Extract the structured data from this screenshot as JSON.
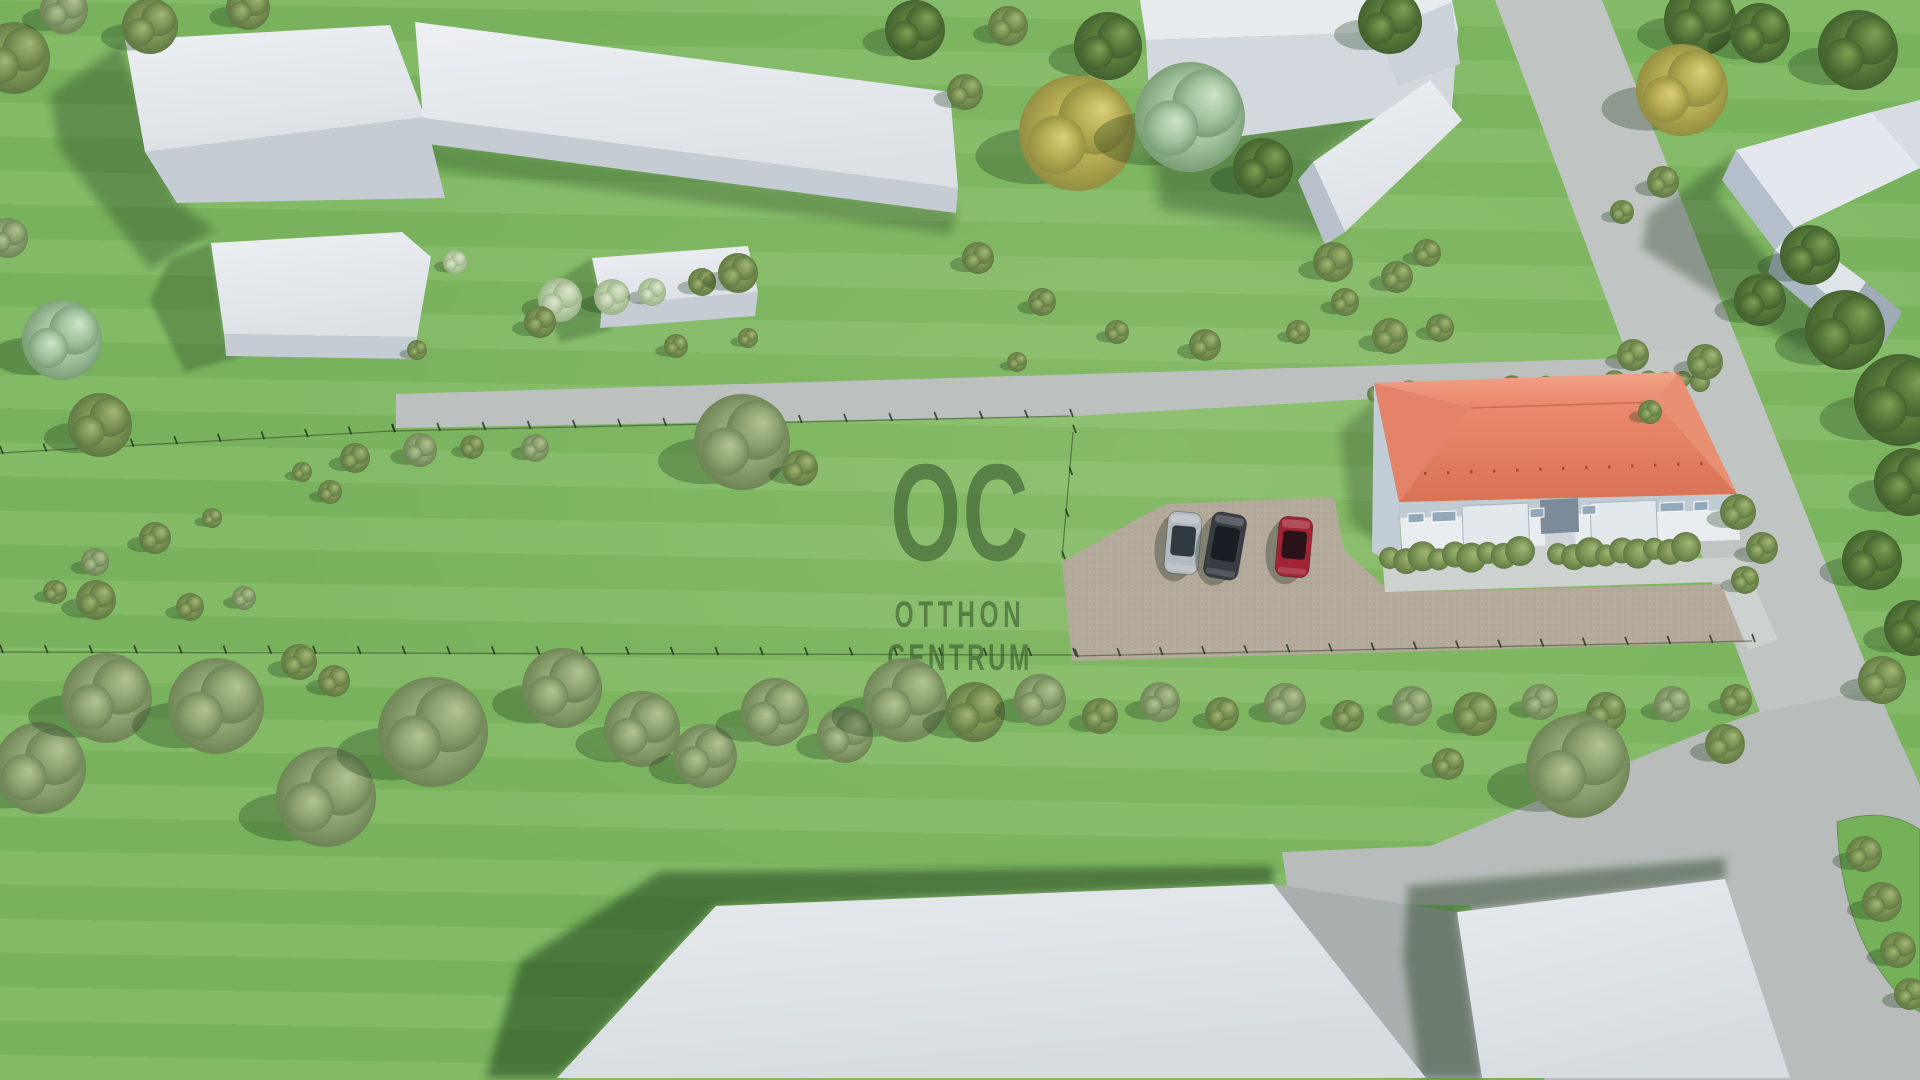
{
  "watermark": {
    "monogram": "OC",
    "line1": "OTTHON",
    "line2": "CENTRUM",
    "color": "#34542c"
  },
  "palette": {
    "grass": "#7bb65e",
    "road": "#bcc0be",
    "walkway": "#cdd1cf",
    "gravel": "#b4aa9b",
    "roof_red": "#e08a6b",
    "building_white": "#e2e6ea",
    "building_side": "#c2c9d2",
    "shadow_green": "#1c381a",
    "watermark_green": "#34542c",
    "car_silver": "#b4bbc0",
    "car_black": "#383d44",
    "car_red": "#a02433"
  },
  "scene": {
    "roads": [
      {
        "name": "main-street-horizontal",
        "pts": "396,394 1705,356 1705,380 1073,416 396,428",
        "fill": "#bcc0be"
      },
      {
        "name": "side-street-vertical",
        "pts": "1495,0 1602,0 1876,690 1760,712",
        "fill": "#c0c4c2"
      },
      {
        "name": "road-curve-apron",
        "path": "M1282,852 L1430,846 C1520,810 1654,748 1758,712 L1878,690 C1898,738 1912,766 1920,786 L1920,1080 L1545,1080 L1470,905 L1290,905 Z",
        "fill": "#b8bcba"
      },
      {
        "name": "road-wedge-between-buildings",
        "pts": "1273,884 1457,912 1482,1078 1426,1078",
        "fill": "#a9afae"
      },
      {
        "name": "grass-island",
        "path": "M1837,822 C1870,810 1900,815 1920,830 L1920,1012 C1900,1000 1880,975 1862,940 C1848,908 1838,865 1837,822 Z",
        "fill": "#74b158",
        "stroke": "rgba(60,90,50,0.45)"
      }
    ],
    "plot": [
      {
        "name": "gravel-parking",
        "pts": "1062,562 1142,516 1166,504 1334,497 1344,550 1390,592 1735,584 1748,642 1072,661",
        "fill": "#b4aa9b",
        "pattern": "grv"
      },
      {
        "name": "north-path",
        "pts": "1640,352 1706,347 1714,371 1648,377",
        "fill": "#c3c7c5"
      },
      {
        "name": "front-walkway",
        "pts": "1383,567 1748,557 1752,581 1385,592",
        "fill": "#cdd1cf"
      },
      {
        "name": "cross-walkway",
        "pts": "1527,545 1556,543 1558,570 1529,572",
        "fill": "#cdd1cf"
      },
      {
        "name": "link-walkway-to-road",
        "pts": "1712,562 1742,558 1778,640 1748,650",
        "fill": "#cdd1cf"
      }
    ],
    "fences": [
      {
        "name": "north-fence-west",
        "x1": 0,
        "y1": 453,
        "x2": 392,
        "y2": 431,
        "posts": 9
      },
      {
        "name": "north-fence-east",
        "x1": 392,
        "y1": 431,
        "x2": 1070,
        "y2": 416,
        "posts": 15
      },
      {
        "name": "west-fence",
        "x1": 1073,
        "y1": 432,
        "x2": 1062,
        "y2": 558,
        "posts": 3
      },
      {
        "name": "south-fence-west",
        "x1": 0,
        "y1": 652,
        "x2": 1073,
        "y2": 655,
        "posts": 24
      },
      {
        "name": "south-fence-east",
        "x1": 1075,
        "y1": 656,
        "x2": 1752,
        "y2": 641,
        "posts": 16
      }
    ],
    "shadows": [
      {
        "name": "shadow-building-topleft-1",
        "pts": "50,95 120,45 175,200 215,230 150,268 60,150",
        "op": 0.32,
        "blur": "f4"
      },
      {
        "name": "shadow-building-topleft-2",
        "pts": "405,140 958,210 950,234 400,164",
        "op": 0.28,
        "blur": "f4"
      },
      {
        "name": "shadow-block-3",
        "pts": "170,260 211,243 224,334 242,356 185,372 150,300",
        "op": 0.3,
        "blur": "f2"
      },
      {
        "name": "shadow-block-4",
        "pts": "558,280 592,258 602,305 612,330 560,342 544,300",
        "op": 0.28,
        "blur": "f2"
      },
      {
        "name": "shadow-courtyard",
        "pts": "1150,135 1452,108 1430,80 1313,162 1340,235 1160,208",
        "op": 0.36,
        "blur": "f6"
      },
      {
        "name": "shadow-corner-house",
        "pts": "1648,215 1736,152 1716,196 1770,262 1836,315 1806,352 1700,285 1642,248",
        "op": 0.33,
        "blur": "f4"
      },
      {
        "name": "shadow-red-house",
        "pts": "1340,430 1380,395 1396,500 1402,565 1350,522",
        "op": 0.26,
        "blur": "f4"
      },
      {
        "name": "shadow-bottom-building-1",
        "pts": "660,872 1273,866 1273,884 716,906 557,1078 486,1078 520,962",
        "op": 0.5,
        "blur": "f4"
      },
      {
        "name": "shadow-bottom-building-2",
        "pts": "1408,886 1725,858 1725,879 1457,912 1482,1078 1420,1078 1404,960",
        "op": 0.42,
        "blur": "f4"
      }
    ],
    "buildings": [
      {
        "name": "building-topleft-1-roof",
        "pts": "125,40 390,25 425,117 145,152",
        "fill": "url(#gTop)"
      },
      {
        "name": "building-topleft-1-side",
        "pts": "145,152 425,117 445,198 177,203",
        "fill": "#c6ccd4"
      },
      {
        "name": "building-topleft-2-roof",
        "pts": "415,22 950,92 958,188 423,118",
        "fill": "url(#gTop)"
      },
      {
        "name": "building-topleft-2-side",
        "pts": "423,118 958,188 956,213 421,143",
        "fill": "#c6ccd4"
      },
      {
        "name": "block-3-roof",
        "pts": "211,243 402,232 431,257 417,337 224,334",
        "fill": "url(#gTop)"
      },
      {
        "name": "block-3-side",
        "pts": "224,334 417,337 415,359 226,356",
        "fill": "#c6ccd4"
      },
      {
        "name": "block-4-roof",
        "pts": "592,258 748,246 758,292 602,305",
        "fill": "url(#gTop)"
      },
      {
        "name": "block-4-side",
        "pts": "602,305 758,292 755,316 600,328",
        "fill": "#c6ccd4"
      },
      {
        "name": "wall-top-cap",
        "pts": "1140,0 1452,0 1458,30 1146,40",
        "fill": "#e8ebee"
      },
      {
        "name": "wall-top-face",
        "pts": "1146,40 1458,30 1452,108 1152,148",
        "fill": "#d3d8de"
      },
      {
        "name": "wall-corner",
        "pts": "1378,34 1452,2 1460,64 1398,86",
        "fill": "#ccd2d9"
      },
      {
        "name": "diagonal-building-roof",
        "pts": "1313,162 1430,80 1462,120 1345,232",
        "fill": "url(#gTop)"
      },
      {
        "name": "diagonal-building-end",
        "pts": "1313,162 1345,232 1325,245 1298,180",
        "fill": "#b8c1cb"
      },
      {
        "name": "corner-house-main-roof",
        "pts": "1736,150 1872,112 1920,168 1794,228",
        "fill": "#e4e8ee"
      },
      {
        "name": "corner-house-roof-right",
        "pts": "1872,112 1920,100 1920,168",
        "fill": "#d8dde4"
      },
      {
        "name": "corner-house-left-wall",
        "pts": "1736,150 1794,228 1775,250 1722,180",
        "fill": "#b4bfcb"
      },
      {
        "name": "corner-house-wing-roof",
        "pts": "1775,250 1794,228 1866,282 1846,312",
        "fill": "#dfe4ea"
      },
      {
        "name": "corner-house-wing-wall",
        "pts": "1775,250 1846,312 1836,330 1768,272",
        "fill": "#aab6c3"
      },
      {
        "name": "corner-house-gable",
        "pts": "1846,312 1866,282 1902,312 1884,344",
        "fill": "#9fabb9"
      },
      {
        "name": "bottom-building-1",
        "pts": "716,906 1273,884 1426,1078 557,1078",
        "fill": "url(#gBot)"
      },
      {
        "name": "bottom-building-2",
        "pts": "1457,912 1725,879 1790,1078 1482,1078",
        "fill": "url(#gBot)"
      }
    ],
    "house": {
      "back_hedge": {
        "x1": 1375,
        "y1": 396,
        "x2": 1700,
        "y2": 380,
        "r": 10,
        "n": 20,
        "v": "o"
      },
      "faces": [
        {
          "name": "house-west-wall",
          "pts": "1374,383 1399,502 1402,568 1372,552",
          "fill": "#c3cdd8"
        },
        {
          "name": "house-facade",
          "pts": "1399,502 1737,494 1740,540 1402,550",
          "fill": "#e9edf0"
        },
        {
          "name": "facade-eave-shade",
          "pts": "1399,502 1737,494 1736,510 1400,518",
          "fill": "rgba(120,140,160,0.35)"
        },
        {
          "name": "porch-left",
          "pts": "1462,506 1528,503 1530,556 1464,559",
          "fill": "#e3e8ec",
          "stroke": "#aab4be"
        },
        {
          "name": "porch-right",
          "pts": "1590,503 1656,500 1658,552 1592,555",
          "fill": "#e3e8ec",
          "stroke": "#aab4be"
        },
        {
          "name": "entry-recess",
          "pts": "1540,500 1578,498 1579,532 1541,534",
          "fill": "#7c8a99"
        },
        {
          "name": "entry-steps",
          "pts": "1545,534 1575,532 1576,556 1546,558",
          "fill": "#cfd5d9"
        },
        {
          "name": "window-1",
          "pts": "1408,514 1424,513 1424,522 1408,523",
          "fill": "#93a9ba",
          "stroke": "#ffffff"
        },
        {
          "name": "window-2",
          "pts": "1432,512 1456,511 1456,521 1432,522",
          "fill": "#93a9ba",
          "stroke": "#ffffff"
        },
        {
          "name": "window-3",
          "pts": "1530,509 1544,508 1544,517 1530,518",
          "fill": "#93a9ba",
          "stroke": "#ffffff"
        },
        {
          "name": "window-4",
          "pts": "1582,506 1596,505 1596,514 1582,515",
          "fill": "#93a9ba",
          "stroke": "#ffffff"
        },
        {
          "name": "window-5",
          "pts": "1660,503 1684,502 1684,511 1660,512",
          "fill": "#93a9ba",
          "stroke": "#ffffff"
        },
        {
          "name": "window-6",
          "pts": "1694,502 1708,501 1708,510 1694,511",
          "fill": "#93a9ba",
          "stroke": "#ffffff"
        }
      ],
      "roof": [
        {
          "name": "roof-north-slope",
          "pts": "1374,383 1679,372 1656,402 1470,408",
          "fill": "url(#gRoofN)"
        },
        {
          "name": "roof-south-slope",
          "pts": "1470,408 1656,402 1737,494 1399,502",
          "fill": "url(#gRoofS)"
        },
        {
          "name": "roof-west-hip",
          "pts": "1374,383 1470,408 1399,502",
          "fill": "#e4826a"
        },
        {
          "name": "roof-east-hip",
          "pts": "1679,372 1737,494 1656,402",
          "fill": "#e98f72"
        }
      ],
      "ridge": {
        "x1": 1470,
        "y1": 408,
        "x2": 1656,
        "y2": 402
      },
      "roof_dots": {
        "x1": 1424,
        "y1": 472,
        "x2": 1700,
        "y2": 462,
        "n": 13
      },
      "front_hedges": [
        {
          "x1": 1390,
          "y1": 560,
          "x2": 1520,
          "y2": 553,
          "r": 13,
          "n": 9,
          "v": "o"
        },
        {
          "x1": 1558,
          "y1": 556,
          "x2": 1686,
          "y2": 549,
          "r": 13,
          "n": 9,
          "v": "o"
        }
      ]
    },
    "cars": [
      {
        "name": "car-silver",
        "cx": 1183,
        "cy": 543,
        "w": 34,
        "h": 62,
        "rot": 5,
        "body": "#b4bbc0",
        "glass": "#2f3a42"
      },
      {
        "name": "car-black",
        "cx": 1225,
        "cy": 546,
        "w": 35,
        "h": 66,
        "rot": 10,
        "body": "#383d44",
        "glass": "#191e24"
      },
      {
        "name": "car-red",
        "cx": 1294,
        "cy": 547,
        "w": 34,
        "h": 60,
        "rot": 5,
        "body": "#a02433",
        "glass": "#2a1318"
      }
    ],
    "trees": [
      [
        14,
        58,
        36,
        "o"
      ],
      [
        64,
        10,
        24,
        "s"
      ],
      [
        150,
        26,
        28,
        "o"
      ],
      [
        248,
        8,
        22,
        "o"
      ],
      [
        8,
        238,
        20,
        "s"
      ],
      [
        62,
        340,
        40,
        "m"
      ],
      [
        100,
        425,
        32,
        "o"
      ],
      [
        355,
        458,
        15,
        "o"
      ],
      [
        420,
        450,
        17,
        "s"
      ],
      [
        472,
        447,
        12,
        "o"
      ],
      [
        535,
        448,
        14,
        "s"
      ],
      [
        330,
        492,
        12,
        "o"
      ],
      [
        302,
        472,
        10,
        "o"
      ],
      [
        155,
        538,
        16,
        "o"
      ],
      [
        95,
        562,
        14,
        "s"
      ],
      [
        55,
        592,
        12,
        "o"
      ],
      [
        212,
        518,
        10,
        "o"
      ],
      [
        560,
        300,
        22,
        "p"
      ],
      [
        612,
        297,
        18,
        "p"
      ],
      [
        652,
        292,
        14,
        "p"
      ],
      [
        455,
        262,
        12,
        "p"
      ],
      [
        702,
        282,
        14,
        "o"
      ],
      [
        738,
        273,
        20,
        "o"
      ],
      [
        742,
        442,
        48,
        "s"
      ],
      [
        800,
        468,
        18,
        "o"
      ],
      [
        96,
        600,
        20,
        "o"
      ],
      [
        190,
        607,
        14,
        "o"
      ],
      [
        244,
        598,
        12,
        "s"
      ],
      [
        299,
        662,
        18,
        "o"
      ],
      [
        334,
        681,
        16,
        "o"
      ],
      [
        40,
        768,
        46,
        "s"
      ],
      [
        107,
        698,
        45,
        "s"
      ],
      [
        216,
        706,
        48,
        "s"
      ],
      [
        326,
        797,
        50,
        "s"
      ],
      [
        433,
        732,
        55,
        "s"
      ],
      [
        562,
        688,
        40,
        "s"
      ],
      [
        642,
        729,
        38,
        "s"
      ],
      [
        705,
        756,
        32,
        "s"
      ],
      [
        775,
        712,
        34,
        "s"
      ],
      [
        845,
        735,
        28,
        "s"
      ],
      [
        905,
        700,
        42,
        "s"
      ],
      [
        975,
        712,
        30,
        "o"
      ],
      [
        1040,
        700,
        26,
        "s"
      ],
      [
        1100,
        716,
        18,
        "o"
      ],
      [
        1160,
        702,
        20,
        "s"
      ],
      [
        1222,
        714,
        17,
        "o"
      ],
      [
        1285,
        704,
        21,
        "s"
      ],
      [
        1348,
        716,
        16,
        "o"
      ],
      [
        1412,
        706,
        20,
        "s"
      ],
      [
        1540,
        702,
        18,
        "s"
      ],
      [
        1606,
        712,
        20,
        "o"
      ],
      [
        1672,
        704,
        18,
        "s"
      ],
      [
        1736,
        700,
        16,
        "o"
      ],
      [
        1578,
        766,
        52,
        "s"
      ],
      [
        1475,
        714,
        22,
        "o"
      ],
      [
        1448,
        764,
        16,
        "o"
      ],
      [
        1725,
        744,
        20,
        "o"
      ],
      [
        915,
        30,
        30,
        "d"
      ],
      [
        965,
        92,
        18,
        "o"
      ],
      [
        1008,
        26,
        20,
        "o"
      ],
      [
        978,
        258,
        16,
        "o"
      ],
      [
        1042,
        302,
        14,
        "o"
      ],
      [
        1117,
        332,
        12,
        "o"
      ],
      [
        1205,
        345,
        16,
        "o"
      ],
      [
        1298,
        332,
        12,
        "o"
      ],
      [
        1017,
        362,
        10,
        "o"
      ],
      [
        1345,
        302,
        14,
        "o"
      ],
      [
        1390,
        336,
        18,
        "o"
      ],
      [
        1440,
        328,
        14,
        "o"
      ],
      [
        1077,
        133,
        58,
        "y"
      ],
      [
        1190,
        117,
        55,
        "m"
      ],
      [
        1108,
        46,
        34,
        "d"
      ],
      [
        1263,
        168,
        30,
        "d"
      ],
      [
        1333,
        262,
        20,
        "o"
      ],
      [
        1397,
        277,
        16,
        "o"
      ],
      [
        1427,
        253,
        14,
        "o"
      ],
      [
        1390,
        22,
        32,
        "d"
      ],
      [
        1700,
        20,
        36,
        "d"
      ],
      [
        1760,
        33,
        30,
        "d"
      ],
      [
        1682,
        90,
        46,
        "y"
      ],
      [
        1858,
        50,
        40,
        "d"
      ],
      [
        1663,
        182,
        16,
        "o"
      ],
      [
        1622,
        212,
        12,
        "o"
      ],
      [
        1810,
        255,
        30,
        "d"
      ],
      [
        1760,
        300,
        26,
        "d"
      ],
      [
        1845,
        330,
        40,
        "d"
      ],
      [
        1900,
        400,
        46,
        "d"
      ],
      [
        1908,
        482,
        34,
        "d"
      ],
      [
        1872,
        560,
        30,
        "d"
      ],
      [
        1912,
        628,
        28,
        "d"
      ],
      [
        1882,
        680,
        24,
        "o"
      ],
      [
        1633,
        355,
        16,
        "o"
      ],
      [
        1705,
        362,
        18,
        "o"
      ],
      [
        1650,
        412,
        12,
        "o"
      ],
      [
        1738,
        512,
        18,
        "o"
      ],
      [
        1762,
        548,
        16,
        "o"
      ],
      [
        1745,
        580,
        14,
        "o"
      ],
      [
        1864,
        854,
        18,
        "o"
      ],
      [
        1882,
        902,
        20,
        "o"
      ],
      [
        1898,
        950,
        18,
        "o"
      ],
      [
        1910,
        994,
        16,
        "o"
      ],
      [
        417,
        350,
        10,
        "o"
      ],
      [
        540,
        322,
        16,
        "o"
      ],
      [
        676,
        346,
        12,
        "o"
      ],
      [
        748,
        338,
        10,
        "o"
      ]
    ]
  }
}
